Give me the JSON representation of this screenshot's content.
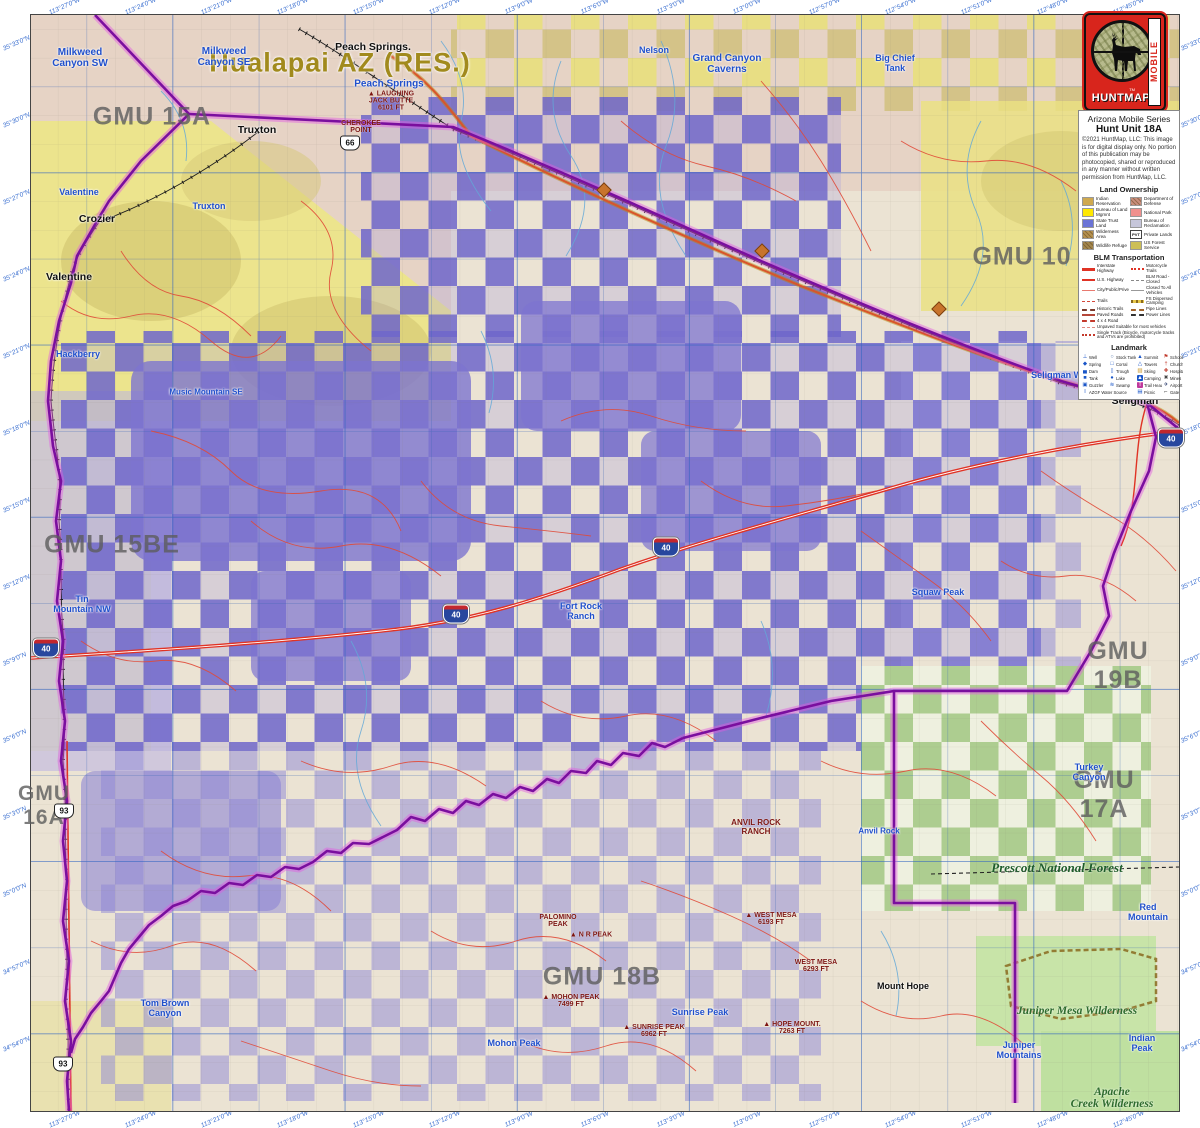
{
  "header": {
    "series": "Arizona Mobile Series",
    "unit": "Hunt Unit 18A",
    "copyright": "©2021 HuntMap, LLC: This image is for digital display only. No portion of this publication may be photocopied, shared or reproduced in any manner without written permission from HuntMap, LLC.",
    "logo_word": "HUNTMAP",
    "logo_mobile": "MOBILE",
    "logo_tm": "TM"
  },
  "legend": {
    "land_ownership": {
      "title": "Land Ownership",
      "items": [
        {
          "label": "Indian Reservation",
          "color": "#cfa94f"
        },
        {
          "label": "Department of Defense",
          "color": "#c98f7e",
          "hatch": true
        },
        {
          "label": "Bureau of Land Mgmnt",
          "color": "#ffe800"
        },
        {
          "label": "National Park",
          "color": "#f0918e"
        },
        {
          "label": "State Trust Land",
          "color": "#6b74d6"
        },
        {
          "label": "Bureau of Reclamation",
          "color": "#c6c6da"
        },
        {
          "label": "Wilderness Area",
          "color": "#b5914f",
          "hatch": true
        },
        {
          "label": "Private Lands",
          "color": "#ffffff",
          "tag": "PVT"
        },
        {
          "label": "Wildlife Refuge",
          "color": "#a3874e",
          "hatch": true
        },
        {
          "label": "US Forest Service",
          "color": "#cdbf56"
        }
      ]
    },
    "transportation": {
      "title": "BLM Transportation",
      "pairs": [
        {
          "label": "Interstate Highway",
          "style": "interstate"
        },
        {
          "label": "Motorcycle Trails",
          "style": "moto"
        },
        {
          "label": "U.S. Highway",
          "style": "ushwy"
        },
        {
          "label": "BLM Road - Closed",
          "style": "blmclosed"
        },
        {
          "label": "City/Public/Prive",
          "style": "city"
        },
        {
          "label": "Closed To All Vehicles",
          "style": "closedall"
        },
        {
          "label": "Trails",
          "style": "trails"
        },
        {
          "label": "FS Dispersed Camping",
          "style": "fscamp"
        },
        {
          "label": "Historic Trails",
          "style": "historic"
        },
        {
          "label": "Pipe Lines",
          "style": "pipe"
        },
        {
          "label": "Paved Roads",
          "style": "paved"
        },
        {
          "label": "Power Lines",
          "style": "power"
        },
        {
          "label": "4 x 4 Road",
          "style": "4x4"
        }
      ],
      "full": [
        {
          "label": "Unpaved Suitable for most vehicles",
          "style": "unpaved"
        },
        {
          "label": "Single Track (Bicycle, motorcycle tracks and ATVs are prohibited)",
          "style": "single"
        }
      ]
    },
    "landmark": {
      "title": "Landmark",
      "items": [
        {
          "label": "Well",
          "glyph": "⊥",
          "fg": "#1a56c8"
        },
        {
          "label": "Stock Tank",
          "glyph": "○",
          "fg": "#5577aa"
        },
        {
          "label": "Summit",
          "glyph": "▲",
          "fg": "#1a56c8"
        },
        {
          "label": "School",
          "glyph": "⚑",
          "fg": "#c0392b"
        },
        {
          "label": "Spring",
          "glyph": "◆",
          "fg": "#1a56c8"
        },
        {
          "label": "Corral",
          "glyph": "□",
          "fg": "#1a56c8"
        },
        {
          "label": "Towers",
          "glyph": "△",
          "fg": "#1a56c8"
        },
        {
          "label": "Church",
          "glyph": "†",
          "fg": "#c0392b"
        },
        {
          "label": "Dam",
          "glyph": "▄",
          "fg": "#1a56c8"
        },
        {
          "label": "Trough",
          "glyph": "▯",
          "fg": "#1a56c8"
        },
        {
          "label": "Skiing",
          "glyph": "▨",
          "fg": "#c89018"
        },
        {
          "label": "Hospital",
          "glyph": "✚",
          "fg": "#c0392b"
        },
        {
          "label": "Tank",
          "glyph": "■",
          "fg": "#1a56c8"
        },
        {
          "label": "Lake",
          "glyph": "●",
          "fg": "#1a56c8"
        },
        {
          "label": "Camping",
          "glyph": "▲",
          "fg": "#ffffff",
          "bg": "#1a56c8"
        },
        {
          "label": "Mines",
          "glyph": "✖",
          "fg": "#444444"
        },
        {
          "label": "Guzzler",
          "glyph": "▣",
          "fg": "#1a56c8"
        },
        {
          "label": "Swamp",
          "glyph": "≋",
          "fg": "#1a56c8"
        },
        {
          "label": "Trail Head",
          "glyph": "T",
          "fg": "#ffffff",
          "bg": "#c0399c"
        },
        {
          "label": "Airport",
          "glyph": "✈",
          "fg": "#223366"
        },
        {
          "label": "AZGF Water Source",
          "glyph": "I",
          "fg": "#1a56c8",
          "span": 2
        },
        {
          "label": "Picnic",
          "glyph": "▤",
          "fg": "#1a56c8"
        },
        {
          "label": "Gate",
          "glyph": "⌐",
          "fg": "#222222"
        }
      ]
    }
  },
  "map": {
    "colors": {
      "state_trust_purple": "#6e66cc",
      "blm_yellow": "#ece48d",
      "reservation_tan": "#e6d3c5",
      "forest_green": "#9cc47c",
      "boundary_purple": "#7a0f9e",
      "road_red": "#e03325"
    },
    "labels": [
      {
        "c": "res",
        "t": "Hualapai AZ (RES.)",
        "x": 340,
        "y": 63
      },
      {
        "c": "gmu",
        "t": "GMU 15A",
        "x": 152,
        "y": 117
      },
      {
        "c": "gmu",
        "t": "GMU 10",
        "x": 1022,
        "y": 257
      },
      {
        "c": "gmu",
        "t": "GMU 15BE",
        "x": 112,
        "y": 545
      },
      {
        "c": "gmu",
        "t": "GMU 19B",
        "x": 1118,
        "y": 666
      },
      {
        "c": "gmu",
        "t": "GMU 17A",
        "x": 1104,
        "y": 795
      },
      {
        "c": "gmu",
        "t": "GMU 18B",
        "x": 602,
        "y": 977
      },
      {
        "c": "gmu",
        "t": "GMU\n16A",
        "x": 44,
        "y": 806,
        "s": 21
      },
      {
        "c": "town",
        "t": "Peach Springs.",
        "x": 373,
        "y": 47
      },
      {
        "c": "town",
        "t": "Truxton",
        "x": 257,
        "y": 130
      },
      {
        "c": "town",
        "t": "Crozier",
        "x": 97,
        "y": 219
      },
      {
        "c": "town",
        "t": "Valentine",
        "x": 69,
        "y": 277
      },
      {
        "c": "town",
        "t": "Seligman",
        "x": 1135,
        "y": 401
      },
      {
        "c": "town",
        "t": "Mount Hope",
        "x": 903,
        "y": 986,
        "s": 9
      },
      {
        "c": "peak",
        "t": "Anvil Rock\nRanch",
        "x": 756,
        "y": 827,
        "s": 8
      },
      {
        "c": "quad",
        "t": "Milkweed\nCanyon SW",
        "x": 80,
        "y": 58
      },
      {
        "c": "quad",
        "t": "Milkweed\nCanyon SE",
        "x": 224,
        "y": 57
      },
      {
        "c": "quad",
        "t": "Peach Springs",
        "x": 389,
        "y": 84
      },
      {
        "c": "quad",
        "t": "Nelson",
        "x": 654,
        "y": 50,
        "s": 9
      },
      {
        "c": "quad",
        "t": "Grand Canyon\nCaverns",
        "x": 727,
        "y": 64
      },
      {
        "c": "quad",
        "t": "Big Chief\nTank",
        "x": 895,
        "y": 63,
        "s": 9
      },
      {
        "c": "quad",
        "t": "Rhodes Canyon",
        "x": 1150,
        "y": 60,
        "s": 9
      },
      {
        "c": "quad",
        "t": "Valentine",
        "x": 79,
        "y": 192,
        "s": 9
      },
      {
        "c": "quad",
        "t": "Truxton",
        "x": 209,
        "y": 206,
        "s": 9
      },
      {
        "c": "quad",
        "t": "Hackberry",
        "x": 78,
        "y": 354,
        "s": 9
      },
      {
        "c": "quad",
        "t": "Music Mountain SE",
        "x": 206,
        "y": 392,
        "s": 8
      },
      {
        "c": "quad",
        "t": "Tin\nMountain NW",
        "x": 82,
        "y": 604,
        "s": 9
      },
      {
        "c": "quad",
        "t": "Seligman West",
        "x": 1063,
        "y": 375,
        "s": 9
      },
      {
        "c": "quad",
        "t": "Squaw Peak",
        "x": 938,
        "y": 592,
        "s": 9
      },
      {
        "c": "quad",
        "t": "Fort Rock\nRanch",
        "x": 581,
        "y": 611,
        "s": 9
      },
      {
        "c": "quad",
        "t": "Turkey\nCanyon",
        "x": 1089,
        "y": 772,
        "s": 9
      },
      {
        "c": "quad",
        "t": "Red Mountain",
        "x": 1148,
        "y": 912,
        "s": 9
      },
      {
        "c": "quad",
        "t": "Indian\nPeak",
        "x": 1142,
        "y": 1043,
        "s": 9
      },
      {
        "c": "quad",
        "t": "Juniper\nMountains",
        "x": 1019,
        "y": 1050,
        "s": 9
      },
      {
        "c": "quad",
        "t": "Mohon Peak",
        "x": 514,
        "y": 1043,
        "s": 9
      },
      {
        "c": "quad",
        "t": "Sunrise Peak",
        "x": 700,
        "y": 1012,
        "s": 9
      },
      {
        "c": "quad",
        "t": "Tom Brown\nCanyon",
        "x": 165,
        "y": 1008,
        "s": 9
      },
      {
        "c": "quad",
        "t": "Anvil Rock",
        "x": 879,
        "y": 831,
        "s": 8
      },
      {
        "c": "peak",
        "t": "▲ Laughing\nJack Butte\n6101 FT",
        "x": 391,
        "y": 101
      },
      {
        "c": "peak",
        "t": "Cherokee\nPoint",
        "x": 361,
        "y": 127
      },
      {
        "c": "peak",
        "t": "▲ Mohon Peak\n7499 FT",
        "x": 571,
        "y": 1001
      },
      {
        "c": "peak",
        "t": "▲ Sunrise Peak\n6962 FT",
        "x": 654,
        "y": 1031
      },
      {
        "c": "peak",
        "t": "Palomino\nPeak",
        "x": 558,
        "y": 921
      },
      {
        "c": "peak",
        "t": "▲ N R Peak",
        "x": 591,
        "y": 935
      },
      {
        "c": "peak",
        "t": "▲ West Mesa\n6193 FT",
        "x": 771,
        "y": 919
      },
      {
        "c": "peak",
        "t": "West Mesa\n6293 FT",
        "x": 816,
        "y": 966
      },
      {
        "c": "peak",
        "t": "▲ Hope Mount.\n7263 FT",
        "x": 792,
        "y": 1028
      },
      {
        "c": "forest",
        "t": "Prescott National Forest",
        "x": 1057,
        "y": 868
      },
      {
        "c": "wild",
        "t": "Juniper Mesa Wilderness",
        "x": 1077,
        "y": 1011
      },
      {
        "c": "wild",
        "t": "Apache\nCreek Wilderness",
        "x": 1112,
        "y": 1098
      }
    ],
    "shields": [
      {
        "c": "i40",
        "t": "40",
        "x": 46,
        "y": 648
      },
      {
        "c": "i40",
        "t": "40",
        "x": 456,
        "y": 614
      },
      {
        "c": "i40",
        "t": "40",
        "x": 666,
        "y": 547
      },
      {
        "c": "i40",
        "t": "40",
        "x": 1171,
        "y": 438
      },
      {
        "c": "us",
        "t": "93",
        "x": 64,
        "y": 811
      },
      {
        "c": "us",
        "t": "93",
        "x": 63,
        "y": 1064
      },
      {
        "c": "us",
        "t": "66",
        "x": 350,
        "y": 143
      },
      {
        "c": "r66",
        "t": "",
        "x": 604,
        "y": 190
      },
      {
        "c": "r66",
        "t": "",
        "x": 762,
        "y": 251
      },
      {
        "c": "r66",
        "t": "",
        "x": 939,
        "y": 309
      }
    ]
  },
  "edges": {
    "top": [
      "113°27'0\"W",
      "113°24'0\"W",
      "113°21'0\"W",
      "113°18'0\"W",
      "113°15'0\"W",
      "113°12'0\"W",
      "113°9'0\"W",
      "113°6'0\"W",
      "113°3'0\"W",
      "113°0'0\"W",
      "112°57'0\"W",
      "112°54'0\"W",
      "112°51'0\"W",
      "112°48'0\"W",
      "112°45'0\"W"
    ],
    "bottom": [
      "113°27'0\"W",
      "113°24'0\"W",
      "113°21'0\"W",
      "113°18'0\"W",
      "113°15'0\"W",
      "113°12'0\"W",
      "113°9'0\"W",
      "113°6'0\"W",
      "113°3'0\"W",
      "113°0'0\"W",
      "112°57'0\"W",
      "112°54'0\"W",
      "112°51'0\"W",
      "112°48'0\"W",
      "112°45'0\"W"
    ],
    "left": [
      "35°33'0\"N",
      "35°30'0\"N",
      "35°27'0\"N",
      "35°24'0\"N",
      "35°21'0\"N",
      "35°18'0\"N",
      "35°15'0\"N",
      "35°12'0\"N",
      "35°9'0\"N",
      "35°6'0\"N",
      "35°3'0\"N",
      "35°0'0\"N",
      "34°57'0\"N",
      "34°54'0\"N"
    ],
    "right": [
      "35°33'0\"N",
      "35°30'0\"N",
      "35°27'0\"N",
      "35°24'0\"N",
      "35°21'0\"N",
      "35°18'0\"N",
      "35°15'0\"N",
      "35°12'0\"N",
      "35°9'0\"N",
      "35°6'0\"N",
      "35°3'0\"N",
      "35°0'0\"N",
      "34°57'0\"N",
      "34°54'0\"N"
    ]
  }
}
